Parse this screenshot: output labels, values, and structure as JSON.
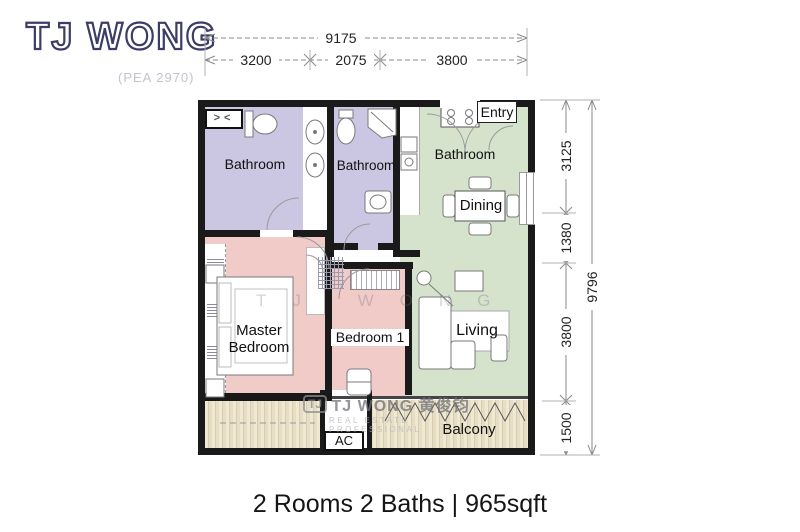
{
  "logo": {
    "name": "TJ WONG",
    "registration": "(PEA 2970)"
  },
  "dimensions": {
    "top": {
      "overall": "9175",
      "segments": [
        "3200",
        "2075",
        "3800"
      ]
    },
    "right": {
      "overall": "9796",
      "segments": [
        "3125",
        "1380",
        "3800",
        "1500"
      ]
    }
  },
  "rooms": {
    "bathroom_master": {
      "label": "Bathroom"
    },
    "bathroom_middle": {
      "label": "Bathroom"
    },
    "bathroom_kitchen": {
      "label": "Bathroom"
    },
    "entry": {
      "label": "Entry"
    },
    "dining": {
      "label": "Dining"
    },
    "living": {
      "label": "Living"
    },
    "master_bedroom": {
      "label": "Master Bedroom"
    },
    "bedroom1": {
      "label": "Bedroom 1"
    },
    "ac": {
      "label": "AC"
    },
    "balcony": {
      "label": "Balcony"
    }
  },
  "symbols": {
    "shower": "><"
  },
  "watermark": {
    "badge": "TJ",
    "name": "TJ WONG 黄俊钧",
    "tagline": "REAL ESTATE PROFESSIONAL",
    "ghost_letters": "TJ WONG"
  },
  "caption": "2 Rooms 2 Baths | 965sqft",
  "colors": {
    "wall": "#1a1a1a",
    "bathroom": "#cbc7e3",
    "bedroom": "#f1cbc8",
    "living_green": "#d5e3cc",
    "logo": "#3c3c66"
  }
}
